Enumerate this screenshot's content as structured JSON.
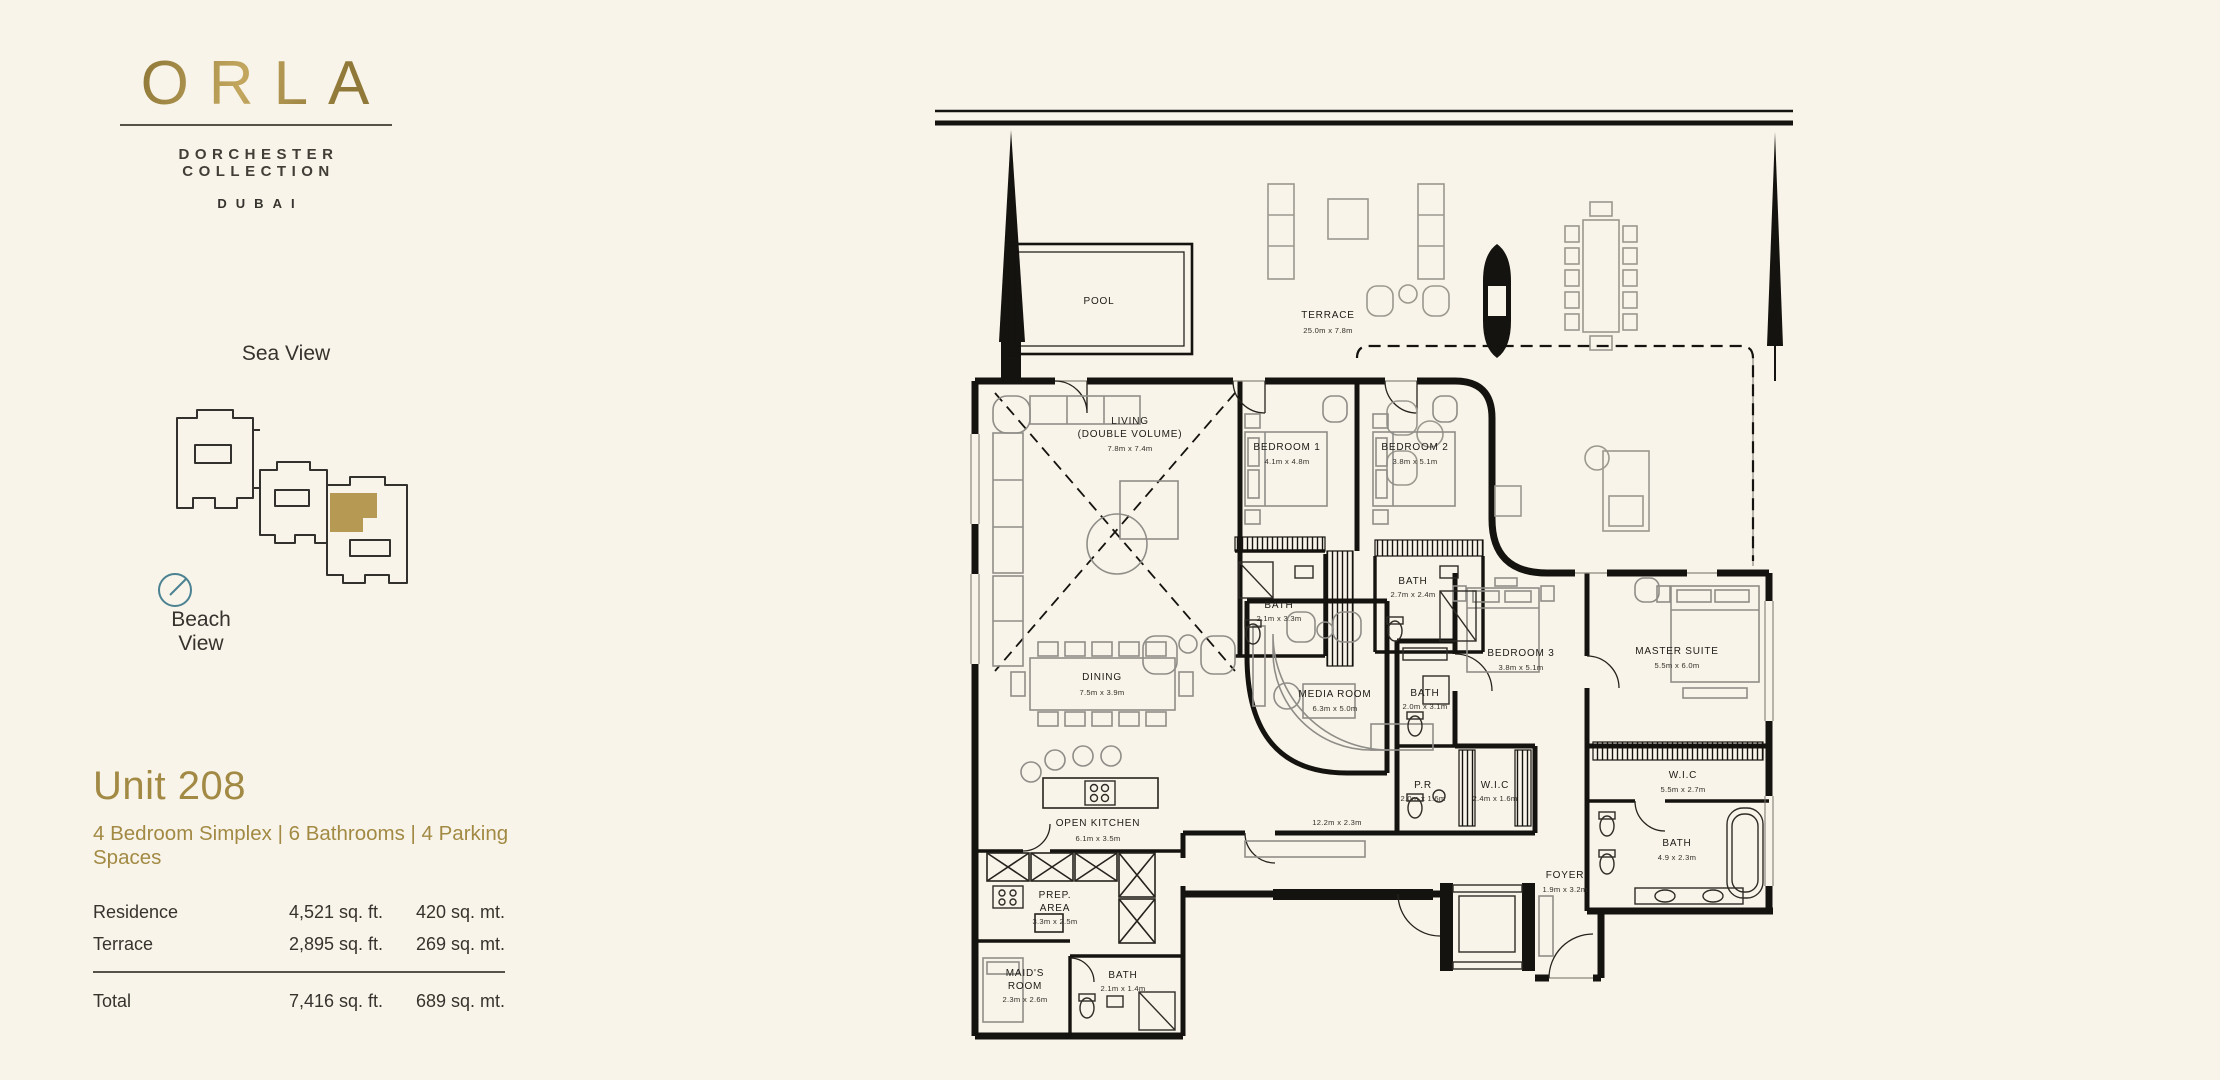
{
  "colors": {
    "background": "#f8f4e9",
    "gold": "#a28a44",
    "ink": "#15130f",
    "compass_teal": "#4b8292",
    "keyplan_highlight": "#b09147"
  },
  "brand": {
    "name": "ORLA",
    "collection": "DORCHESTER COLLECTION",
    "city": "DUBAI"
  },
  "keyplan": {
    "sea_label": "Sea View",
    "beach_label": "Beach View"
  },
  "unit": {
    "title": "Unit 208",
    "subtitle": "4 Bedroom Simplex | 6 Bathrooms | 4 Parking Spaces",
    "areas": [
      {
        "label": "Residence",
        "sqft": "4,521 sq. ft.",
        "sqmt": "420 sq. mt."
      },
      {
        "label": "Terrace",
        "sqft": "2,895 sq. ft.",
        "sqmt": "269 sq. mt."
      }
    ],
    "total": {
      "label": "Total",
      "sqft": "7,416 sq. ft.",
      "sqmt": "689 sq. mt."
    }
  },
  "plan": {
    "rooms": {
      "pool": {
        "name": "POOL",
        "dims": ""
      },
      "terrace": {
        "name": "TERRACE",
        "dims": "25.0m x 7.8m"
      },
      "living": {
        "name": "LIVING",
        "name2": "(DOUBLE VOLUME)",
        "dims": "7.8m x 7.4m"
      },
      "bedroom1": {
        "name": "BEDROOM 1",
        "dims": "4.1m x 4.8m"
      },
      "bedroom2": {
        "name": "BEDROOM 2",
        "dims": "3.8m x 5.1m"
      },
      "bath1": {
        "name": "BATH",
        "dims": "2.1m x 3.3m"
      },
      "bath2": {
        "name": "BATH",
        "dims": "2.7m x 2.4m"
      },
      "dining": {
        "name": "DINING",
        "dims": "7.5m x 3.9m"
      },
      "media": {
        "name": "MEDIA ROOM",
        "dims": "6.3m x 5.0m"
      },
      "kitchen": {
        "name": "OPEN KITCHEN",
        "dims": "6.1m x 3.5m"
      },
      "corridor": {
        "dims": "12.2m x 2.3m"
      },
      "bath3": {
        "name": "BATH",
        "dims": "2.0m x 3.1m"
      },
      "pr": {
        "name": "P.R",
        "dims": "2.0m x 1.6m"
      },
      "wic1": {
        "name": "W.I.C",
        "dims": "2.4m x 1.6m"
      },
      "bedroom3": {
        "name": "BEDROOM 3",
        "dims": "3.8m x 5.1m"
      },
      "master": {
        "name": "MASTER SUITE",
        "dims": "5.5m x 6.0m"
      },
      "wic2": {
        "name": "W.I.C",
        "dims": "5.5m x 2.7m"
      },
      "bath_master": {
        "name": "BATH",
        "dims": "4.9 x 2.3m"
      },
      "foyer": {
        "name": "FOYER",
        "dims": "1.9m x 3.2m"
      },
      "prep": {
        "name": "PREP.",
        "name2": "AREA",
        "dims": "3.3m x 2.5m"
      },
      "maid": {
        "name": "MAID'S",
        "name2": "ROOM",
        "dims": "2.3m x 2.6m"
      },
      "bath_maid": {
        "name": "BATH",
        "dims": "2.1m x 1.4m"
      }
    }
  }
}
